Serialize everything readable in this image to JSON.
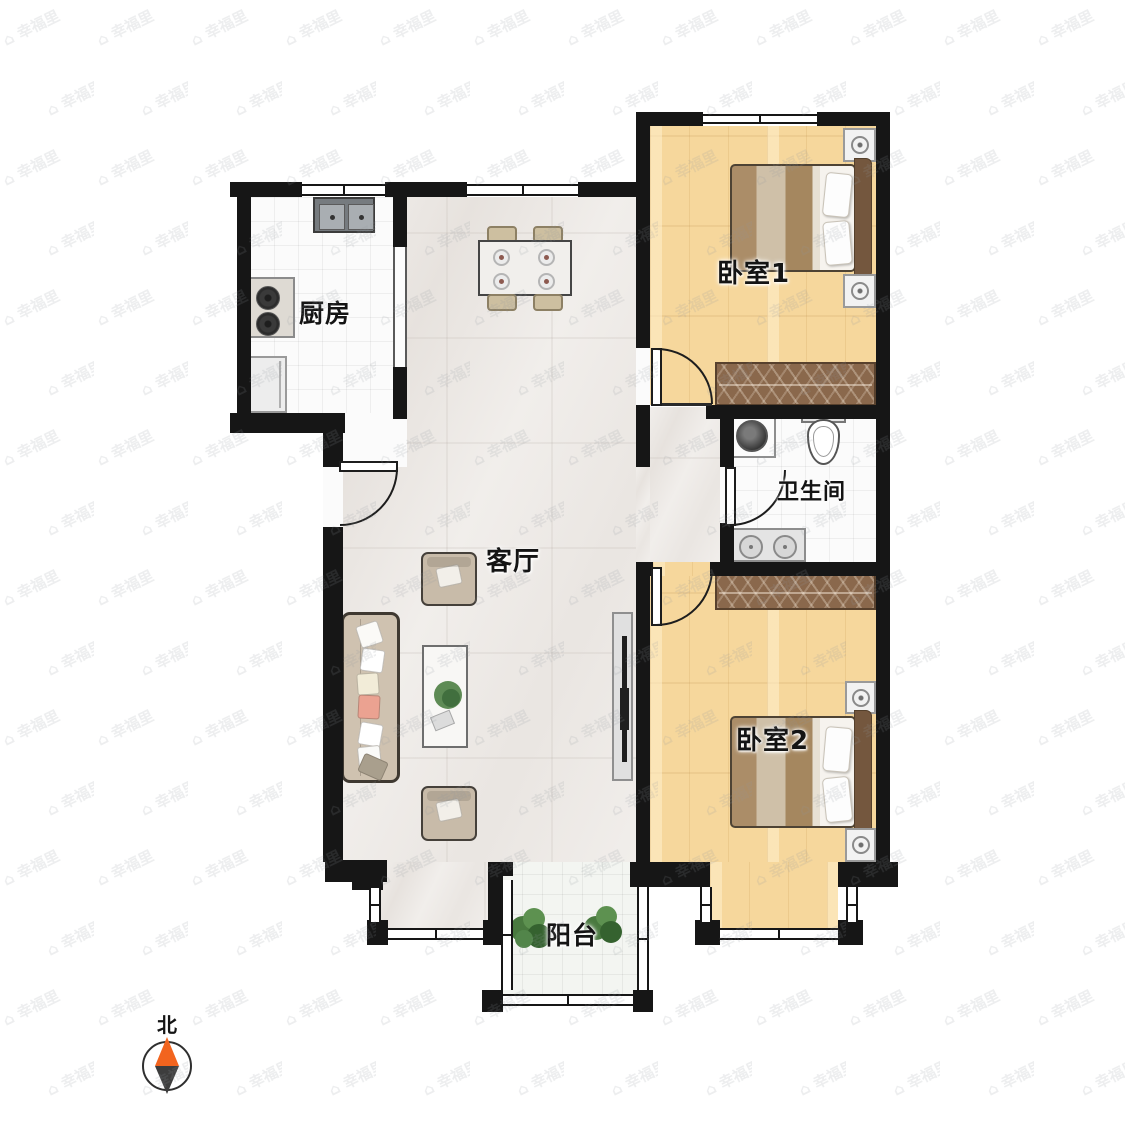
{
  "rooms": {
    "kitchen": {
      "label": "厨房"
    },
    "living_room": {
      "label": "客厅"
    },
    "bedroom1": {
      "label": "卧室1"
    },
    "bathroom": {
      "label": "卫生间"
    },
    "bedroom2": {
      "label": "卧室2"
    },
    "balcony": {
      "label": "阳台"
    }
  },
  "compass": {
    "north_label": "北",
    "needle_north_color": "#f2641e",
    "needle_south_color": "#3d3d3d"
  },
  "watermark": {
    "text": "⌂ 幸福里"
  },
  "colors": {
    "wall": "#161616",
    "wood_floor": "#f6d79c",
    "marble_floor": "#f1eeeb",
    "tile_floor": "#fbfbfb",
    "wardrobe": "#8a684c",
    "bed_blanket": "#a88a66",
    "headboard": "#74573e"
  }
}
